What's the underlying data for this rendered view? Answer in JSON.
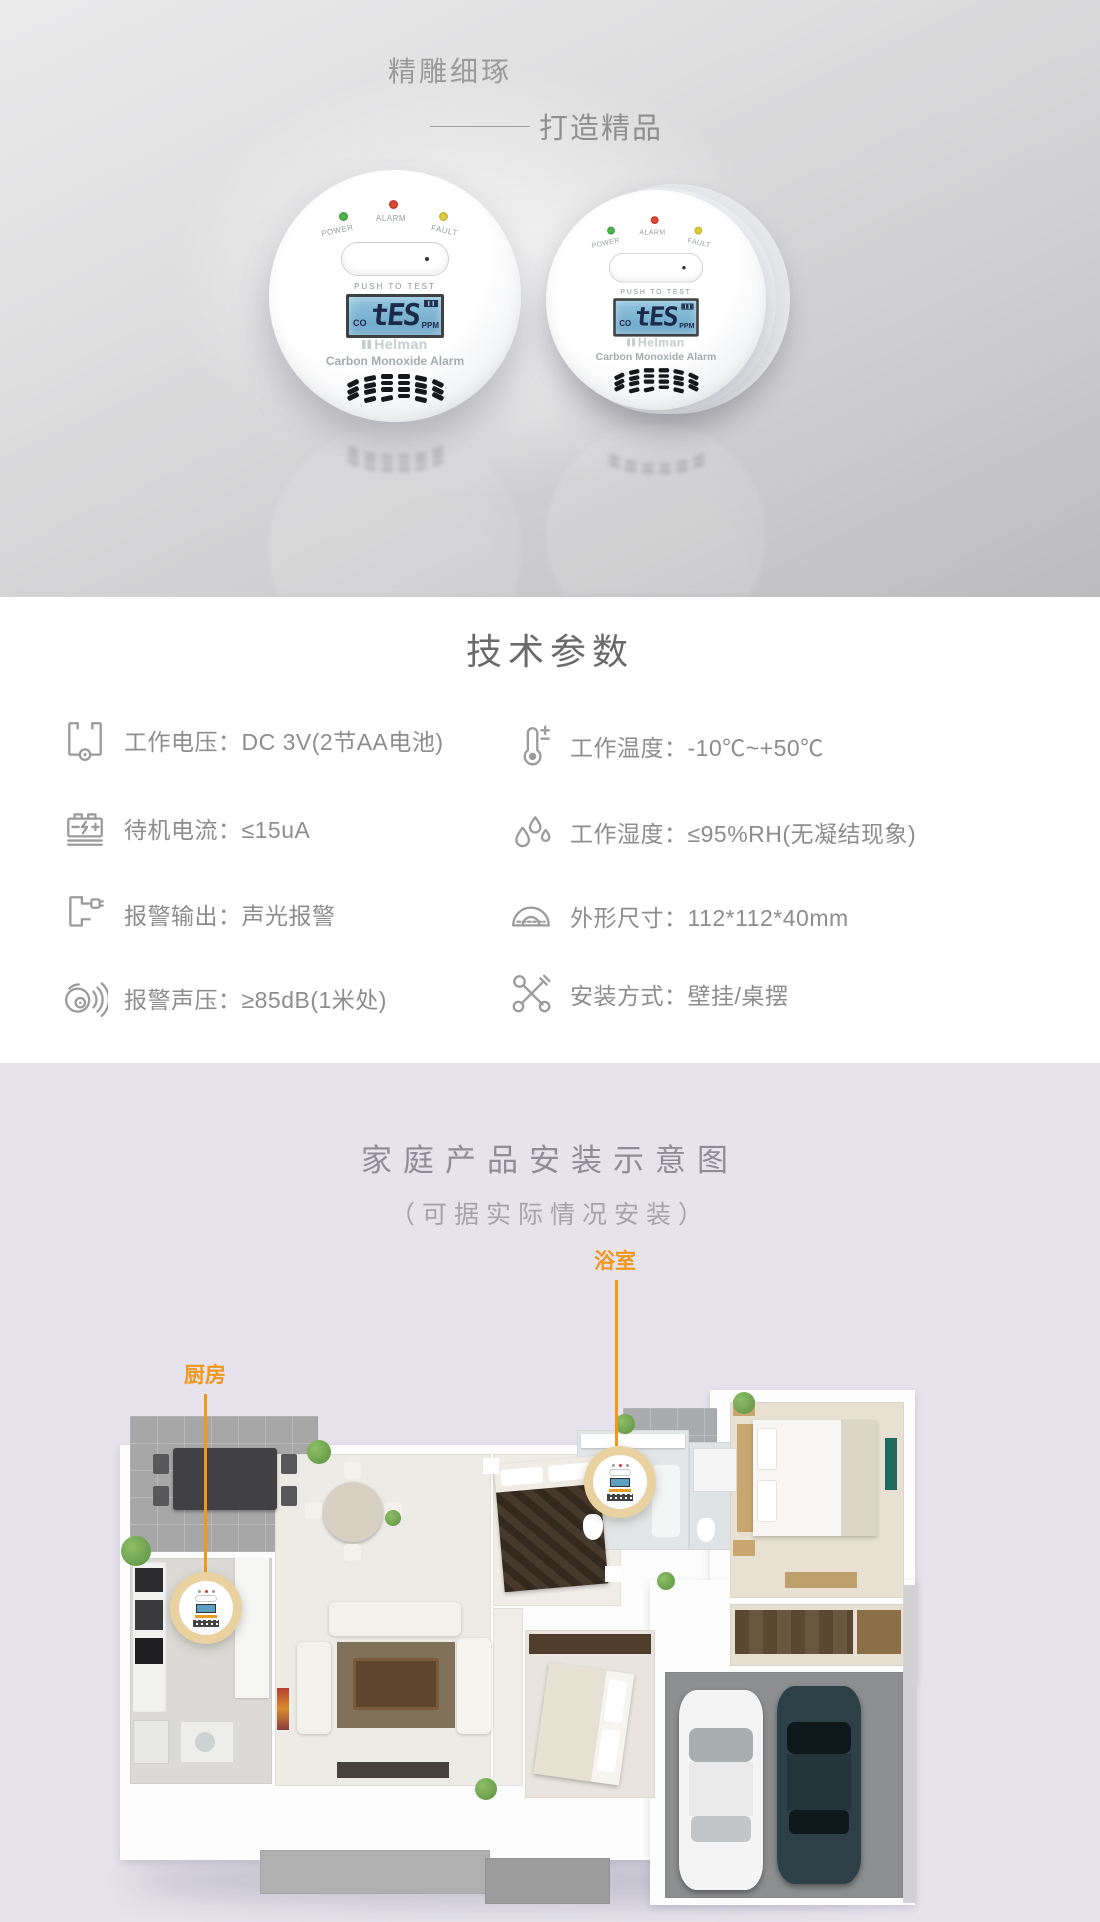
{
  "hero": {
    "title": "精雕细琢",
    "subtitle": "打造精品",
    "device": {
      "brand": "Helman",
      "name": "Carbon Monoxide Alarm",
      "leds": [
        {
          "label": "POWER",
          "color": "#3fa13b"
        },
        {
          "label": "ALARM",
          "color": "#cf3227"
        },
        {
          "label": "FAULT",
          "color": "#cfc22f"
        }
      ],
      "button_label": "PUSH TO TEST",
      "lcd": {
        "left": "CO",
        "value": "tES",
        "right": "PPM"
      }
    }
  },
  "specs": {
    "title": "技术参数",
    "left": [
      {
        "icon": "battery-voltage-icon",
        "label": "工作电压：",
        "value": "DC 3V(2节AA电池)"
      },
      {
        "icon": "standby-current-icon",
        "label": "待机电流：",
        "value": "≤15uA"
      },
      {
        "icon": "alarm-output-icon",
        "label": "报警输出：",
        "value": "声光报警"
      },
      {
        "icon": "sound-pressure-icon",
        "label": "报警声压：",
        "value": "≥85dB(1米处)"
      }
    ],
    "right": [
      {
        "icon": "thermometer-icon",
        "label": "工作温度：",
        "value": "-10℃~+50℃"
      },
      {
        "icon": "humidity-icon",
        "label": "工作湿度：",
        "value": "≤95%RH(无凝结现象)"
      },
      {
        "icon": "dimensions-icon",
        "label": "外形尺寸：",
        "value": "112*112*40mm"
      },
      {
        "icon": "install-method-icon",
        "label": "安装方式：",
        "value": "壁挂/桌摆"
      }
    ]
  },
  "installation": {
    "title": "家庭产品安装示意图",
    "subtitle": "（可据实际情况安装）",
    "accent_color": "#f0971d",
    "callouts": [
      {
        "label": "浴室"
      },
      {
        "label": "厨房"
      }
    ]
  }
}
